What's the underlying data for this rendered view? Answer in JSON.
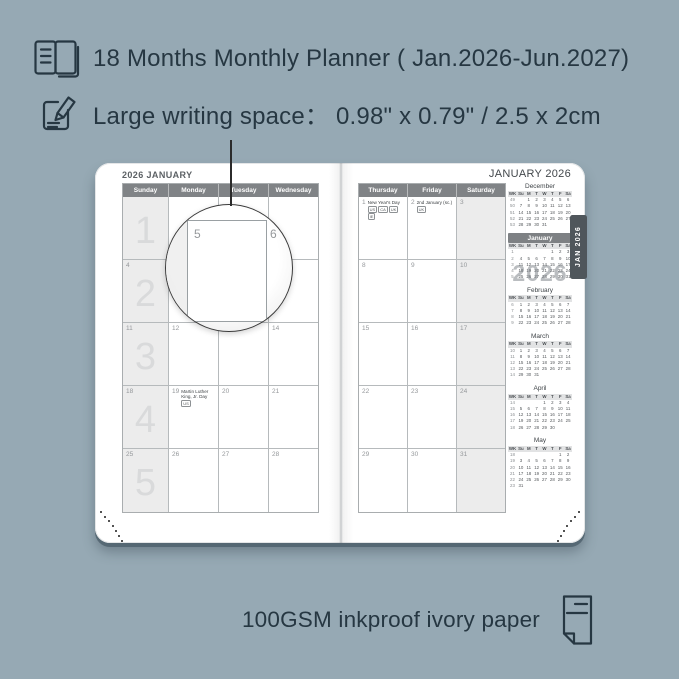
{
  "colors": {
    "background": "#96a9b4",
    "ink": "#263742",
    "page": "#ffffff",
    "grid_header_bg": "#808386",
    "grid_line": "#b6babc",
    "shaded_column": "#ececec",
    "tab_bg": "#4f565b"
  },
  "features": {
    "line1": "18 Months Monthly Planner ( Jan.2026-Jun.2027)",
    "line2": "Large writing space：  0.98\" x 0.79\" / 2.5 x 2cm",
    "bottom": "100GSM inkproof ivory paper"
  },
  "icons": {
    "line1": "open-planner-book-icon",
    "line2": "writing-pencil-icon",
    "bottom": "paper-sheet-icon"
  },
  "magnifier": {
    "left_date": "5",
    "right_date": "6"
  },
  "left_page": {
    "title": "2026 JANUARY",
    "day_headers": [
      "Sunday",
      "Monday",
      "Tuesday",
      "Wednesday"
    ],
    "shaded_col": 0,
    "week_watermarks": [
      "1",
      "2",
      "3",
      "4",
      "5"
    ],
    "weeks": [
      [
        {
          "date": ""
        },
        {
          "date": ""
        },
        {
          "date": ""
        },
        {
          "date": ""
        }
      ],
      [
        {
          "date": "4"
        },
        {
          "date": "5"
        },
        {
          "date": "6"
        },
        {
          "date": "7"
        }
      ],
      [
        {
          "date": "11"
        },
        {
          "date": "12"
        },
        {
          "date": "13"
        },
        {
          "date": "14"
        }
      ],
      [
        {
          "date": "18"
        },
        {
          "date": "19",
          "holiday": "Martin Luther King, Jr. Day",
          "badges": [
            "US"
          ]
        },
        {
          "date": "20"
        },
        {
          "date": "21"
        }
      ],
      [
        {
          "date": "25"
        },
        {
          "date": "26"
        },
        {
          "date": "27"
        },
        {
          "date": "28"
        }
      ]
    ]
  },
  "right_page": {
    "title": "JANUARY 2026",
    "day_headers": [
      "Thursday",
      "Friday",
      "Saturday"
    ],
    "shaded_col": 2,
    "tab": "JAN 2026",
    "year_watermark": "2026",
    "weeks": [
      [
        {
          "date": "1",
          "holiday": "New Year's Day",
          "badges": [
            "US",
            "CA",
            "UK",
            "IE"
          ]
        },
        {
          "date": "2",
          "holiday": "2nd January (sc.)",
          "badges": [
            "UK"
          ]
        },
        {
          "date": "3"
        }
      ],
      [
        {
          "date": "8"
        },
        {
          "date": "9"
        },
        {
          "date": "10"
        }
      ],
      [
        {
          "date": "15"
        },
        {
          "date": "16"
        },
        {
          "date": "17"
        }
      ],
      [
        {
          "date": "22"
        },
        {
          "date": "23"
        },
        {
          "date": "24"
        }
      ],
      [
        {
          "date": "29"
        },
        {
          "date": "30"
        },
        {
          "date": "31"
        }
      ]
    ],
    "mini_calendars": [
      {
        "name": "December",
        "selected": false,
        "header": [
          "WK",
          "Su",
          "M",
          "T",
          "W",
          "T",
          "F",
          "Sa"
        ],
        "rows": [
          [
            "49",
            "",
            "1",
            "2",
            "3",
            "4",
            "5",
            "6"
          ],
          [
            "50",
            "7",
            "8",
            "9",
            "10",
            "11",
            "12",
            "13"
          ],
          [
            "51",
            "14",
            "15",
            "16",
            "17",
            "18",
            "19",
            "20"
          ],
          [
            "52",
            "21",
            "22",
            "23",
            "24",
            "25",
            "26",
            "27"
          ],
          [
            "53",
            "28",
            "29",
            "30",
            "31",
            "",
            "",
            ""
          ]
        ]
      },
      {
        "name": "January",
        "selected": true,
        "header": [
          "WK",
          "Su",
          "M",
          "T",
          "W",
          "T",
          "F",
          "Sa"
        ],
        "rows": [
          [
            "1",
            "",
            "",
            "",
            "",
            "1",
            "2",
            "3"
          ],
          [
            "2",
            "4",
            "5",
            "6",
            "7",
            "8",
            "9",
            "10"
          ],
          [
            "3",
            "11",
            "12",
            "13",
            "14",
            "15",
            "16",
            "17"
          ],
          [
            "4",
            "18",
            "19",
            "20",
            "21",
            "22",
            "23",
            "24"
          ],
          [
            "5",
            "25",
            "26",
            "27",
            "28",
            "29",
            "30",
            "31"
          ]
        ]
      },
      {
        "name": "February",
        "selected": false,
        "header": [
          "WK",
          "Su",
          "M",
          "T",
          "W",
          "T",
          "F",
          "Sa"
        ],
        "rows": [
          [
            "6",
            "1",
            "2",
            "3",
            "4",
            "5",
            "6",
            "7"
          ],
          [
            "7",
            "8",
            "9",
            "10",
            "11",
            "12",
            "13",
            "14"
          ],
          [
            "8",
            "15",
            "16",
            "17",
            "18",
            "19",
            "20",
            "21"
          ],
          [
            "9",
            "22",
            "23",
            "24",
            "25",
            "26",
            "27",
            "28"
          ]
        ]
      },
      {
        "name": "March",
        "selected": false,
        "header": [
          "WK",
          "Su",
          "M",
          "T",
          "W",
          "T",
          "F",
          "Sa"
        ],
        "rows": [
          [
            "10",
            "1",
            "2",
            "3",
            "4",
            "5",
            "6",
            "7"
          ],
          [
            "11",
            "8",
            "9",
            "10",
            "11",
            "12",
            "13",
            "14"
          ],
          [
            "12",
            "15",
            "16",
            "17",
            "18",
            "19",
            "20",
            "21"
          ],
          [
            "13",
            "22",
            "23",
            "24",
            "25",
            "26",
            "27",
            "28"
          ],
          [
            "14",
            "29",
            "30",
            "31",
            "",
            "",
            "",
            ""
          ]
        ]
      },
      {
        "name": "April",
        "selected": false,
        "header": [
          "WK",
          "Su",
          "M",
          "T",
          "W",
          "T",
          "F",
          "Sa"
        ],
        "rows": [
          [
            "14",
            "",
            "",
            "",
            "1",
            "2",
            "3",
            "4"
          ],
          [
            "15",
            "5",
            "6",
            "7",
            "8",
            "9",
            "10",
            "11"
          ],
          [
            "16",
            "12",
            "13",
            "14",
            "15",
            "16",
            "17",
            "18"
          ],
          [
            "17",
            "19",
            "20",
            "21",
            "22",
            "23",
            "24",
            "25"
          ],
          [
            "18",
            "26",
            "27",
            "28",
            "29",
            "30",
            "",
            ""
          ]
        ]
      },
      {
        "name": "May",
        "selected": false,
        "header": [
          "WK",
          "Su",
          "M",
          "T",
          "W",
          "T",
          "F",
          "Sa"
        ],
        "rows": [
          [
            "18",
            "",
            "",
            "",
            "",
            "",
            "1",
            "2"
          ],
          [
            "19",
            "3",
            "4",
            "5",
            "6",
            "7",
            "8",
            "9"
          ],
          [
            "20",
            "10",
            "11",
            "12",
            "13",
            "14",
            "15",
            "16"
          ],
          [
            "21",
            "17",
            "18",
            "19",
            "20",
            "21",
            "22",
            "23"
          ],
          [
            "22",
            "24",
            "25",
            "26",
            "27",
            "28",
            "29",
            "30"
          ],
          [
            "23",
            "31",
            "",
            "",
            "",
            "",
            "",
            ""
          ]
        ]
      }
    ]
  }
}
